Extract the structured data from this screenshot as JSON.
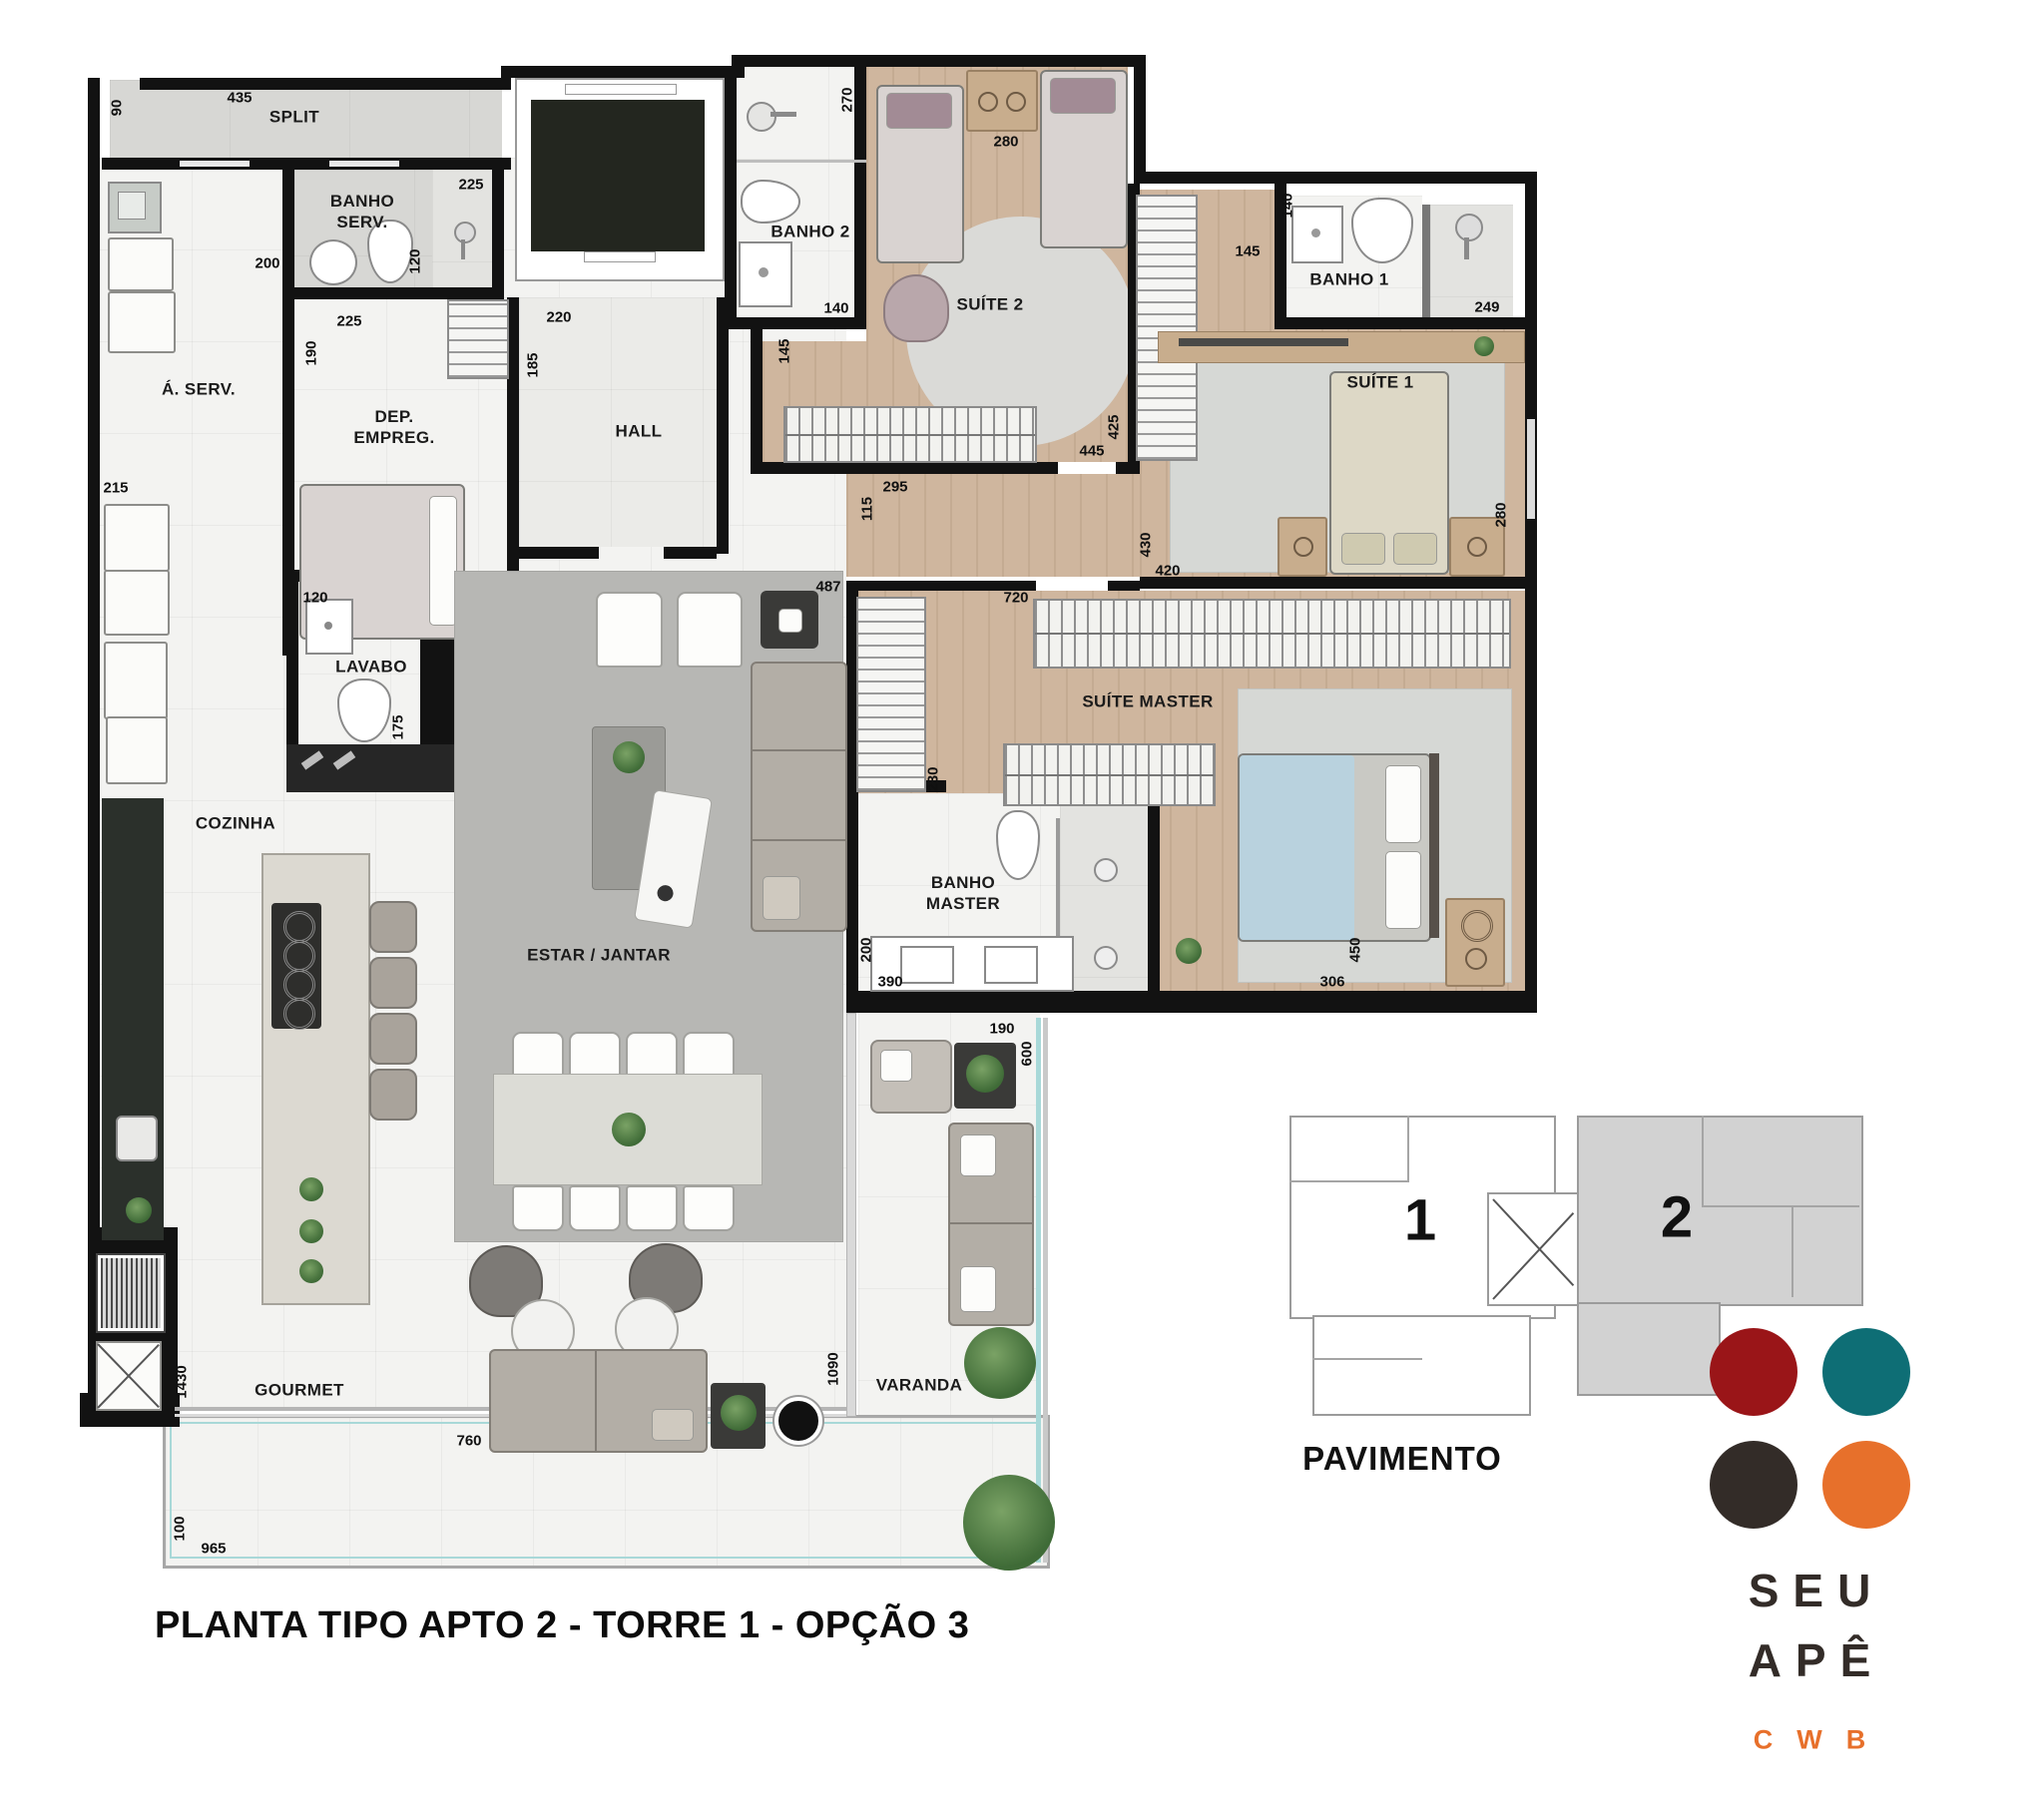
{
  "title": "PLANTA TIPO APTO 2 - TORRE 1 - OPÇÃO 3",
  "rooms": {
    "split": "SPLIT",
    "banho_serv": "BANHO\nSERV.",
    "dep_empreg": "DEP.\nEMPREG.",
    "hall": "HALL",
    "banho2": "BANHO 2",
    "suite2": "SUÍTE 2",
    "banho1": "BANHO 1",
    "suite1": "SUÍTE 1",
    "a_serv": "Á. SERV.",
    "lavabo": "LAVABO",
    "cozinha": "COZINHA",
    "estar_jantar": "ESTAR / JANTAR",
    "suite_master": "SUÍTE MASTER",
    "banho_master": "BANHO\nMASTER",
    "gourmet": "GOURMET",
    "varanda": "VARANDA"
  },
  "dims": {
    "split_width": "435",
    "split_depth": "90",
    "banho_serv_width": "225",
    "banho_serv_depth": "120",
    "aserv_corridor": "200",
    "dep_width": "225",
    "dep_depth": "190",
    "hall_width": "220",
    "hall_depth": "185",
    "banho2_depth": "270",
    "banho2_width": "140",
    "suite2_beds": "280",
    "suite2_door": "145",
    "closet_depth": "425",
    "suite2_width": "445",
    "corridor_width": "295",
    "corridor_depth": "115",
    "suite1_hall": "430",
    "suite1_door": "420",
    "estar_width": "487",
    "master_closet": "720",
    "aserv_width": "215",
    "lavabo_width": "120",
    "lavabo_depth": "175",
    "master_closet_depth": "230",
    "banho_master_depth": "200",
    "banho_master_vanity": "390",
    "master_bed_wall": "450",
    "master_width": "306",
    "banho1_sink": "140",
    "banho1_door": "145",
    "banho1_width": "249",
    "suite1_depth": "280",
    "varanda_width": "190",
    "varanda_glass": "600",
    "varanda_length": "1090",
    "gourmet_depth": "1430",
    "gourmet_door": "760",
    "terrace_depth": "100",
    "terrace_width": "965"
  },
  "keyplan": {
    "unit1_label": "1",
    "unit2_label": "2",
    "caption": "PAVIMENTO"
  },
  "logo": {
    "word1": "SEU",
    "word2": "APÊ",
    "word3": "CWB",
    "dot_colors": {
      "top_left": "#9a1518",
      "top_right": "#0e6e75",
      "bottom_left": "#332c28",
      "bottom_right": "#e7702b"
    }
  },
  "colors": {
    "wall": "#121212",
    "wood_floor": "#cfb69e",
    "tile_floor": "#d7d7d4",
    "marble_floor": "#f3f3f1",
    "rug": "#b7b7b4",
    "glass_line": "#a8d8d8",
    "keyplan_highlight": "#d2d2d2"
  }
}
